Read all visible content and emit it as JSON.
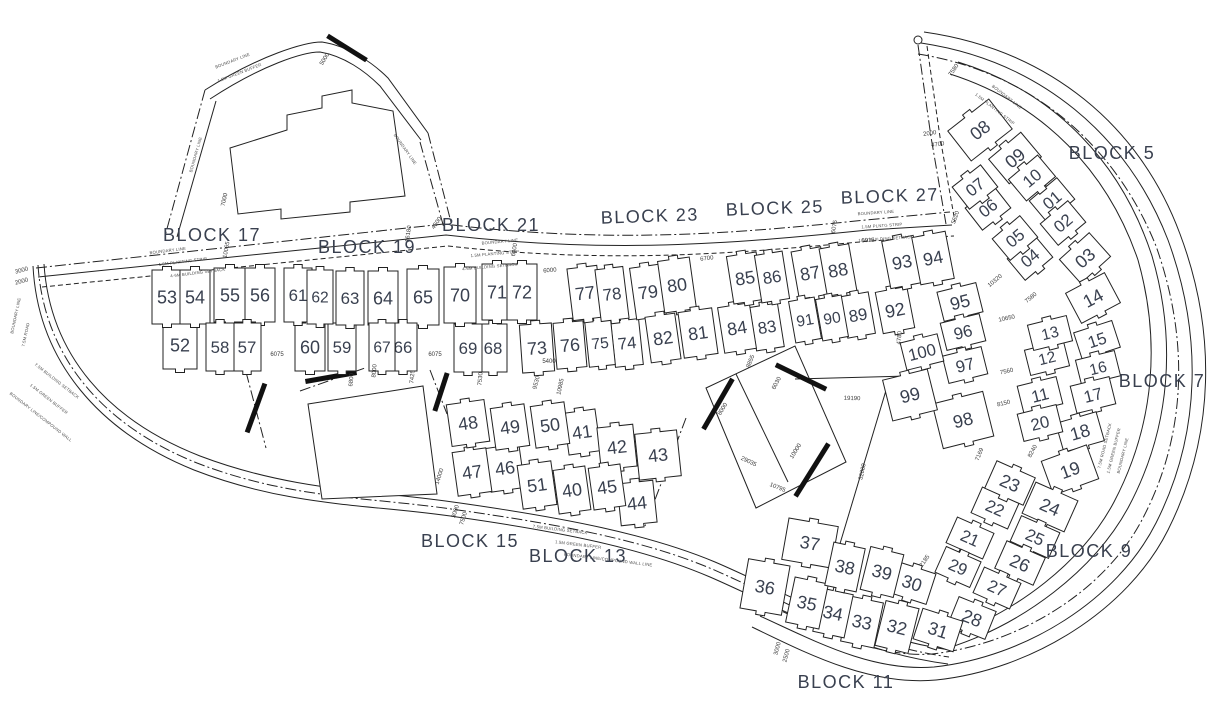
{
  "drawing": {
    "title": "Residential layout site plan with numbered plots",
    "background": "#ffffff",
    "line_color": "#222222",
    "number_color": "#39404f",
    "wall_color": "#111111"
  },
  "blocks": [
    {
      "label": "BLOCK 17",
      "x": 212,
      "y": 241,
      "r": 0
    },
    {
      "label": "BLOCK 19",
      "x": 367,
      "y": 253,
      "r": 0
    },
    {
      "label": "BLOCK 21",
      "x": 491,
      "y": 231,
      "r": 0
    },
    {
      "label": "BLOCK 23",
      "x": 650,
      "y": 222,
      "r": -2
    },
    {
      "label": "BLOCK 25",
      "x": 775,
      "y": 214,
      "r": -2
    },
    {
      "label": "BLOCK 27",
      "x": 890,
      "y": 202,
      "r": -2
    },
    {
      "label": "BLOCK 5",
      "x": 1112,
      "y": 159,
      "r": 0
    },
    {
      "label": "BLOCK 7",
      "x": 1162,
      "y": 387,
      "r": 0
    },
    {
      "label": "BLOCK 9",
      "x": 1089,
      "y": 557,
      "r": 0
    },
    {
      "label": "BLOCK 11",
      "x": 846,
      "y": 688,
      "r": 0
    },
    {
      "label": "BLOCK 13",
      "x": 578,
      "y": 562,
      "r": 0
    },
    {
      "label": "BLOCK 15",
      "x": 470,
      "y": 547,
      "r": 0
    }
  ],
  "plots": [
    {
      "n": "01",
      "x": 1052,
      "y": 200,
      "w": 36,
      "h": 28,
      "r": -40
    },
    {
      "n": "02",
      "x": 1063,
      "y": 223,
      "w": 36,
      "h": 28,
      "r": -40
    },
    {
      "n": "03",
      "x": 1085,
      "y": 258,
      "w": 40,
      "h": 32,
      "r": -42
    },
    {
      "n": "04",
      "x": 1030,
      "y": 258,
      "w": 36,
      "h": 28,
      "r": -40
    },
    {
      "n": "05",
      "x": 1015,
      "y": 238,
      "w": 36,
      "h": 28,
      "r": -40
    },
    {
      "n": "06",
      "x": 988,
      "y": 208,
      "w": 36,
      "h": 28,
      "r": -38
    },
    {
      "n": "07",
      "x": 975,
      "y": 187,
      "w": 36,
      "h": 28,
      "r": -38
    },
    {
      "n": "08",
      "x": 980,
      "y": 130,
      "w": 52,
      "h": 38,
      "r": -38
    },
    {
      "n": "09",
      "x": 1015,
      "y": 158,
      "w": 42,
      "h": 32,
      "r": -40
    },
    {
      "n": "10",
      "x": 1032,
      "y": 178,
      "w": 38,
      "h": 28,
      "r": -40
    },
    {
      "n": "11",
      "x": 1040,
      "y": 395,
      "w": 40,
      "h": 28,
      "r": -14
    },
    {
      "n": "12",
      "x": 1047,
      "y": 358,
      "w": 40,
      "h": 26,
      "r": -14
    },
    {
      "n": "13",
      "x": 1050,
      "y": 333,
      "w": 40,
      "h": 26,
      "r": -14
    },
    {
      "n": "14",
      "x": 1093,
      "y": 298,
      "w": 44,
      "h": 34,
      "r": -28
    },
    {
      "n": "15",
      "x": 1097,
      "y": 340,
      "w": 40,
      "h": 28,
      "r": -18
    },
    {
      "n": "16",
      "x": 1098,
      "y": 368,
      "w": 40,
      "h": 26,
      "r": -14
    },
    {
      "n": "17",
      "x": 1093,
      "y": 395,
      "w": 40,
      "h": 28,
      "r": -14
    },
    {
      "n": "18",
      "x": 1080,
      "y": 432,
      "w": 42,
      "h": 30,
      "r": -16
    },
    {
      "n": "19",
      "x": 1070,
      "y": 470,
      "w": 48,
      "h": 36,
      "r": -20
    },
    {
      "n": "20",
      "x": 1040,
      "y": 423,
      "w": 40,
      "h": 28,
      "r": -14
    },
    {
      "n": "21",
      "x": 970,
      "y": 538,
      "w": 40,
      "h": 28,
      "r": 24
    },
    {
      "n": "22",
      "x": 995,
      "y": 508,
      "w": 40,
      "h": 28,
      "r": 24
    },
    {
      "n": "23",
      "x": 1010,
      "y": 483,
      "w": 42,
      "h": 30,
      "r": 24
    },
    {
      "n": "24",
      "x": 1050,
      "y": 507,
      "w": 46,
      "h": 34,
      "r": 24
    },
    {
      "n": "25",
      "x": 1035,
      "y": 537,
      "w": 42,
      "h": 28,
      "r": 24
    },
    {
      "n": "26",
      "x": 1020,
      "y": 563,
      "w": 42,
      "h": 30,
      "r": 24
    },
    {
      "n": "27",
      "x": 997,
      "y": 588,
      "w": 40,
      "h": 28,
      "r": 24
    },
    {
      "n": "28",
      "x": 972,
      "y": 618,
      "w": 40,
      "h": 30,
      "r": 22
    },
    {
      "n": "29",
      "x": 958,
      "y": 567,
      "w": 38,
      "h": 28,
      "r": 24
    },
    {
      "n": "30",
      "x": 912,
      "y": 583,
      "w": 40,
      "h": 32,
      "r": 18
    },
    {
      "n": "31",
      "x": 938,
      "y": 630,
      "w": 42,
      "h": 32,
      "r": 18
    },
    {
      "n": "32",
      "x": 897,
      "y": 627,
      "w": 34,
      "h": 46,
      "r": 14
    },
    {
      "n": "33",
      "x": 862,
      "y": 622,
      "w": 34,
      "h": 46,
      "r": 12
    },
    {
      "n": "34",
      "x": 833,
      "y": 613,
      "w": 32,
      "h": 44,
      "r": 12
    },
    {
      "n": "35",
      "x": 807,
      "y": 603,
      "w": 34,
      "h": 46,
      "r": 12
    },
    {
      "n": "36",
      "x": 765,
      "y": 587,
      "w": 42,
      "h": 50,
      "r": 10
    },
    {
      "n": "37",
      "x": 810,
      "y": 543,
      "w": 50,
      "h": 42,
      "r": 10
    },
    {
      "n": "38",
      "x": 845,
      "y": 567,
      "w": 32,
      "h": 44,
      "r": 12
    },
    {
      "n": "39",
      "x": 882,
      "y": 572,
      "w": 34,
      "h": 44,
      "r": 14
    },
    {
      "n": "40",
      "x": 572,
      "y": 490,
      "w": 32,
      "h": 44,
      "r": -8
    },
    {
      "n": "41",
      "x": 582,
      "y": 432,
      "w": 32,
      "h": 42,
      "r": -8
    },
    {
      "n": "42",
      "x": 617,
      "y": 447,
      "w": 36,
      "h": 42,
      "r": -6
    },
    {
      "n": "43",
      "x": 658,
      "y": 455,
      "w": 42,
      "h": 46,
      "r": -6
    },
    {
      "n": "44",
      "x": 637,
      "y": 503,
      "w": 36,
      "h": 42,
      "r": -6
    },
    {
      "n": "45",
      "x": 607,
      "y": 487,
      "w": 32,
      "h": 42,
      "r": -8
    },
    {
      "n": "46",
      "x": 505,
      "y": 468,
      "w": 34,
      "h": 44,
      "r": -8
    },
    {
      "n": "47",
      "x": 472,
      "y": 472,
      "w": 34,
      "h": 44,
      "r": -8
    },
    {
      "n": "48",
      "x": 468,
      "y": 423,
      "w": 38,
      "h": 42,
      "r": -8
    },
    {
      "n": "49",
      "x": 510,
      "y": 427,
      "w": 34,
      "h": 42,
      "r": -8
    },
    {
      "n": "50",
      "x": 550,
      "y": 425,
      "w": 34,
      "h": 42,
      "r": -8
    },
    {
      "n": "51",
      "x": 537,
      "y": 485,
      "w": 34,
      "h": 44,
      "r": -8
    },
    {
      "n": "52",
      "x": 180,
      "y": 345,
      "w": 34,
      "h": 48,
      "r": 0
    },
    {
      "n": "53",
      "x": 167,
      "y": 297,
      "w": 30,
      "h": 54,
      "r": 0
    },
    {
      "n": "54",
      "x": 195,
      "y": 297,
      "w": 30,
      "h": 54,
      "r": 0
    },
    {
      "n": "55",
      "x": 230,
      "y": 295,
      "w": 32,
      "h": 54,
      "r": 0
    },
    {
      "n": "56",
      "x": 260,
      "y": 295,
      "w": 30,
      "h": 54,
      "r": 0
    },
    {
      "n": "57",
      "x": 247,
      "y": 347,
      "w": 28,
      "h": 48,
      "r": 0
    },
    {
      "n": "58",
      "x": 220,
      "y": 347,
      "w": 28,
      "h": 48,
      "r": 0
    },
    {
      "n": "59",
      "x": 342,
      "y": 347,
      "w": 28,
      "h": 48,
      "r": 0
    },
    {
      "n": "60",
      "x": 310,
      "y": 347,
      "w": 30,
      "h": 48,
      "r": 0
    },
    {
      "n": "61",
      "x": 298,
      "y": 295,
      "w": 28,
      "h": 54,
      "r": 0
    },
    {
      "n": "62",
      "x": 320,
      "y": 297,
      "w": 26,
      "h": 54,
      "r": 0
    },
    {
      "n": "63",
      "x": 350,
      "y": 298,
      "w": 28,
      "h": 54,
      "r": 0
    },
    {
      "n": "64",
      "x": 383,
      "y": 298,
      "w": 30,
      "h": 54,
      "r": 0
    },
    {
      "n": "65",
      "x": 423,
      "y": 297,
      "w": 32,
      "h": 56,
      "r": 0
    },
    {
      "n": "66",
      "x": 403,
      "y": 347,
      "w": 28,
      "h": 48,
      "r": 0
    },
    {
      "n": "67",
      "x": 382,
      "y": 347,
      "w": 26,
      "h": 48,
      "r": 0
    },
    {
      "n": "68",
      "x": 493,
      "y": 348,
      "w": 28,
      "h": 48,
      "r": 0
    },
    {
      "n": "69",
      "x": 468,
      "y": 348,
      "w": 28,
      "h": 48,
      "r": 0
    },
    {
      "n": "70",
      "x": 460,
      "y": 295,
      "w": 32,
      "h": 56,
      "r": 0
    },
    {
      "n": "71",
      "x": 497,
      "y": 292,
      "w": 30,
      "h": 56,
      "r": 0
    },
    {
      "n": "72",
      "x": 522,
      "y": 292,
      "w": 30,
      "h": 56,
      "r": 0
    },
    {
      "n": "73",
      "x": 537,
      "y": 348,
      "w": 32,
      "h": 48,
      "r": -4
    },
    {
      "n": "74",
      "x": 627,
      "y": 343,
      "w": 28,
      "h": 46,
      "r": -6
    },
    {
      "n": "75",
      "x": 600,
      "y": 343,
      "w": 26,
      "h": 46,
      "r": -6
    },
    {
      "n": "76",
      "x": 570,
      "y": 345,
      "w": 30,
      "h": 46,
      "r": -5
    },
    {
      "n": "77",
      "x": 585,
      "y": 293,
      "w": 30,
      "h": 52,
      "r": -7
    },
    {
      "n": "78",
      "x": 612,
      "y": 294,
      "w": 28,
      "h": 52,
      "r": -7
    },
    {
      "n": "79",
      "x": 648,
      "y": 292,
      "w": 30,
      "h": 52,
      "r": -8
    },
    {
      "n": "80",
      "x": 677,
      "y": 285,
      "w": 32,
      "h": 52,
      "r": -8
    },
    {
      "n": "81",
      "x": 698,
      "y": 333,
      "w": 34,
      "h": 46,
      "r": -8
    },
    {
      "n": "82",
      "x": 663,
      "y": 338,
      "w": 30,
      "h": 46,
      "r": -8
    },
    {
      "n": "83",
      "x": 767,
      "y": 327,
      "w": 28,
      "h": 44,
      "r": -9
    },
    {
      "n": "84",
      "x": 737,
      "y": 328,
      "w": 32,
      "h": 46,
      "r": -9
    },
    {
      "n": "85",
      "x": 745,
      "y": 278,
      "w": 30,
      "h": 48,
      "r": -9
    },
    {
      "n": "86",
      "x": 772,
      "y": 277,
      "w": 28,
      "h": 48,
      "r": -9
    },
    {
      "n": "87",
      "x": 810,
      "y": 273,
      "w": 30,
      "h": 48,
      "r": -10
    },
    {
      "n": "88",
      "x": 838,
      "y": 270,
      "w": 30,
      "h": 48,
      "r": -10
    },
    {
      "n": "89",
      "x": 858,
      "y": 315,
      "w": 28,
      "h": 42,
      "r": -10
    },
    {
      "n": "90",
      "x": 832,
      "y": 318,
      "w": 26,
      "h": 42,
      "r": -10
    },
    {
      "n": "91",
      "x": 805,
      "y": 320,
      "w": 26,
      "h": 42,
      "r": -10
    },
    {
      "n": "92",
      "x": 895,
      "y": 310,
      "w": 32,
      "h": 42,
      "r": -11
    },
    {
      "n": "93",
      "x": 902,
      "y": 262,
      "w": 32,
      "h": 48,
      "r": -11
    },
    {
      "n": "94",
      "x": 933,
      "y": 258,
      "w": 34,
      "h": 48,
      "r": -11
    },
    {
      "n": "95",
      "x": 960,
      "y": 302,
      "w": 40,
      "h": 30,
      "r": -14
    },
    {
      "n": "96",
      "x": 963,
      "y": 332,
      "w": 40,
      "h": 28,
      "r": -14
    },
    {
      "n": "97",
      "x": 965,
      "y": 365,
      "w": 40,
      "h": 28,
      "r": -14
    },
    {
      "n": "98",
      "x": 963,
      "y": 420,
      "w": 52,
      "h": 46,
      "r": -14
    },
    {
      "n": "99",
      "x": 910,
      "y": 395,
      "w": 46,
      "h": 42,
      "r": -14
    },
    {
      "n": "100",
      "x": 922,
      "y": 352,
      "w": 38,
      "h": 28,
      "r": -14
    }
  ],
  "dims": [
    {
      "t": "6075",
      "x": 277,
      "y": 356,
      "r": 0
    },
    {
      "t": "6075",
      "x": 435,
      "y": 356,
      "r": 0
    },
    {
      "t": "5400",
      "x": 549,
      "y": 363,
      "r": 0
    },
    {
      "t": "6000",
      "x": 550,
      "y": 272,
      "r": -5
    },
    {
      "t": "6700",
      "x": 707,
      "y": 260,
      "r": -7
    },
    {
      "t": "6015",
      "x": 868,
      "y": 242,
      "r": -3
    },
    {
      "t": "6075",
      "x": 836,
      "y": 227,
      "r": -80
    },
    {
      "t": "10320",
      "x": 996,
      "y": 282,
      "r": -40
    },
    {
      "t": "7580",
      "x": 1032,
      "y": 299,
      "r": -40
    },
    {
      "t": "10650",
      "x": 1007,
      "y": 320,
      "r": -12
    },
    {
      "t": "7560",
      "x": 1007,
      "y": 373,
      "r": -12
    },
    {
      "t": "8150",
      "x": 1004,
      "y": 405,
      "r": -13
    },
    {
      "t": "8240",
      "x": 1034,
      "y": 452,
      "r": -62
    },
    {
      "t": "7169",
      "x": 981,
      "y": 455,
      "r": -68
    },
    {
      "t": "2185",
      "x": 926,
      "y": 562,
      "r": -55
    },
    {
      "t": "10795",
      "x": 777,
      "y": 489,
      "r": 22
    },
    {
      "t": "19190",
      "x": 852,
      "y": 400,
      "r": 2
    },
    {
      "t": "32000",
      "x": 864,
      "y": 472,
      "r": -78
    },
    {
      "t": "10000",
      "x": 797,
      "y": 452,
      "r": -58
    },
    {
      "t": "29035",
      "x": 748,
      "y": 463,
      "r": 25
    },
    {
      "t": "8000",
      "x": 724,
      "y": 410,
      "r": -58
    },
    {
      "t": "6030",
      "x": 778,
      "y": 384,
      "r": -62
    },
    {
      "t": "8855",
      "x": 752,
      "y": 362,
      "r": -68
    },
    {
      "t": "4780",
      "x": 901,
      "y": 338,
      "r": -85
    },
    {
      "t": "9530",
      "x": 538,
      "y": 383,
      "r": -75
    },
    {
      "t": "10985",
      "x": 562,
      "y": 387,
      "r": -78
    },
    {
      "t": "7530",
      "x": 482,
      "y": 379,
      "r": -85
    },
    {
      "t": "7425",
      "x": 414,
      "y": 377,
      "r": -85
    },
    {
      "t": "14000",
      "x": 441,
      "y": 477,
      "r": -72
    },
    {
      "t": "6800",
      "x": 353,
      "y": 380,
      "r": -85
    },
    {
      "t": "8000",
      "x": 376,
      "y": 371,
      "r": -85
    },
    {
      "t": "16180",
      "x": 410,
      "y": 234,
      "r": -82
    },
    {
      "t": "10065",
      "x": 228,
      "y": 250,
      "r": -80
    },
    {
      "t": "5000",
      "x": 326,
      "y": 60,
      "r": -58
    },
    {
      "t": "7000",
      "x": 226,
      "y": 200,
      "r": -78
    },
    {
      "t": "3000",
      "x": 22,
      "y": 272,
      "r": -15
    },
    {
      "t": "2000",
      "x": 22,
      "y": 283,
      "r": -15
    },
    {
      "t": "4500",
      "x": 438,
      "y": 224,
      "r": -55
    },
    {
      "t": "6400",
      "x": 516,
      "y": 250,
      "r": -80
    },
    {
      "t": "2000",
      "x": 930,
      "y": 135,
      "r": -8
    },
    {
      "t": "4700",
      "x": 938,
      "y": 146,
      "r": -8
    },
    {
      "t": "7580",
      "x": 955,
      "y": 71,
      "r": -55
    },
    {
      "t": "5520",
      "x": 957,
      "y": 218,
      "r": -70
    },
    {
      "t": "3000",
      "x": 457,
      "y": 512,
      "r": -72
    },
    {
      "t": "7500",
      "x": 465,
      "y": 519,
      "r": -72
    },
    {
      "t": "3000",
      "x": 779,
      "y": 649,
      "r": -75
    },
    {
      "t": "2500",
      "x": 788,
      "y": 656,
      "r": -75
    }
  ],
  "road_texts": [
    {
      "t": "BOUNDARY LINE",
      "x": 168,
      "y": 252,
      "r": -7
    },
    {
      "t": "1.5M PLANTING STRIP",
      "x": 183,
      "y": 263,
      "r": -7
    },
    {
      "t": "4-6M BUILDING SETBACK",
      "x": 198,
      "y": 274,
      "r": -7
    },
    {
      "t": "BOUNDARY LINE",
      "x": 500,
      "y": 243,
      "r": -5
    },
    {
      "t": "1.5M PLANTING STRIP",
      "x": 495,
      "y": 255,
      "r": -5
    },
    {
      "t": "4-6M BUILDING SETBACK",
      "x": 490,
      "y": 268,
      "r": -5
    },
    {
      "t": "BOUNDARY LINE",
      "x": 876,
      "y": 214,
      "r": -4
    },
    {
      "t": "1.5M PLNTG STRIP",
      "x": 882,
      "y": 227,
      "r": -4
    },
    {
      "t": "1.5M BUILDING SETBACK",
      "x": 886,
      "y": 240,
      "r": -4
    },
    {
      "t": "7.5M BUILDING SETBACK",
      "x": 560,
      "y": 531,
      "r": 7
    },
    {
      "t": "1.5M GREEN BUFFER",
      "x": 578,
      "y": 546,
      "r": 7
    },
    {
      "t": "BOUNDARY LINE/COMPOUND WALL LINE",
      "x": 608,
      "y": 561,
      "r": 7
    },
    {
      "t": "BOUNDARY LINE",
      "x": 17,
      "y": 316,
      "r": -78
    },
    {
      "t": "7.5M ROAD",
      "x": 27,
      "y": 335,
      "r": -78
    },
    {
      "t": "7.5M BUILDING SETBACK",
      "x": 56,
      "y": 382,
      "r": 38
    },
    {
      "t": "1.5M GREEN BUFFER",
      "x": 48,
      "y": 400,
      "r": 38
    },
    {
      "t": "BOUNDARY LINE/COMPOUND WALL",
      "x": 40,
      "y": 418,
      "r": 38
    },
    {
      "t": "BOUNDARY LINE",
      "x": 1006,
      "y": 98,
      "r": 38
    },
    {
      "t": "1.5M PLANTING STRIP",
      "x": 994,
      "y": 110,
      "r": 38
    },
    {
      "t": "7.5M ROAD SETBACK",
      "x": 1106,
      "y": 446,
      "r": -76
    },
    {
      "t": "1.5M GREEN BUFFER",
      "x": 1115,
      "y": 451,
      "r": -76
    },
    {
      "t": "BOUNDARY LINE",
      "x": 1124,
      "y": 456,
      "r": -76
    },
    {
      "t": "BOUNDARY LINE",
      "x": 233,
      "y": 62,
      "r": -21
    },
    {
      "t": "1.5M GREEN BUFFER",
      "x": 240,
      "y": 74,
      "r": -21
    },
    {
      "t": "BOUNDARY LINE",
      "x": 404,
      "y": 150,
      "r": 55
    },
    {
      "t": "BOUNDARY LINE",
      "x": 197,
      "y": 155,
      "r": -74
    }
  ],
  "walls": [
    {
      "x": 347,
      "y": 48,
      "len": 46,
      "r": 32
    },
    {
      "x": 256,
      "y": 408,
      "len": 52,
      "r": -70
    },
    {
      "x": 331,
      "y": 377,
      "len": 52,
      "r": -10
    },
    {
      "x": 441,
      "y": 392,
      "len": 40,
      "r": -72
    },
    {
      "x": 718,
      "y": 404,
      "len": 58,
      "r": -60
    },
    {
      "x": 801,
      "y": 377,
      "len": 56,
      "r": 26
    },
    {
      "x": 812,
      "y": 470,
      "len": 62,
      "r": -58
    }
  ],
  "survey_marker": {
    "x": 918,
    "y": 40,
    "r": 4
  }
}
